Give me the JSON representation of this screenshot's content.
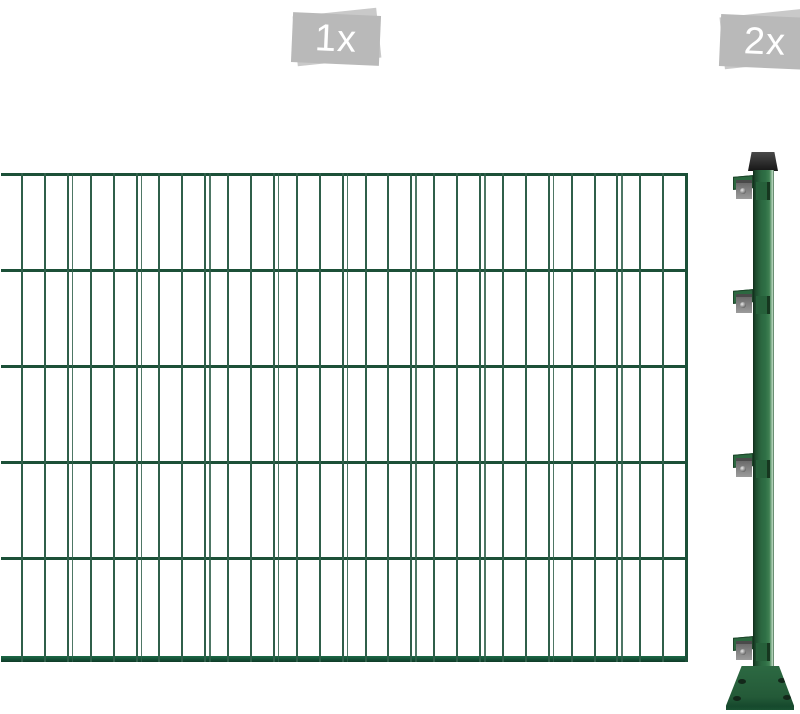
{
  "image": {
    "type": "fence-product-photo",
    "items": [
      {
        "name": "fence-panel",
        "quantity_label": "1x"
      },
      {
        "name": "fence-post",
        "quantity_label": "2x"
      }
    ]
  },
  "colors": {
    "wire-v": "#2f5f4a",
    "wire-h": "#1c5038",
    "bar-top": "#1c6a47",
    "bar-bottom": "#0f3b28",
    "post-green": "#2b6740",
    "cap-dark": "#2a2a2a",
    "metal-gray": "#9a9a9a",
    "badge-back": "#c9c9c9",
    "badge-front": "#b9b9b9",
    "badge-text": "#ffffff"
  },
  "fence": {
    "panel": {
      "rows_y": [
        0,
        96,
        192,
        288,
        384,
        483
      ],
      "bottom_bar_height": 6,
      "verticals": {
        "start": 20,
        "count": 30,
        "spacing": 22.9,
        "twin_every": 3,
        "twin_offset": 5
      }
    },
    "post": {
      "bracket_y": [
        26,
        140,
        304,
        487
      ],
      "base_holes": [
        [
          12,
          13
        ],
        [
          52,
          12
        ],
        [
          7,
          30
        ],
        [
          57,
          29
        ]
      ]
    }
  }
}
